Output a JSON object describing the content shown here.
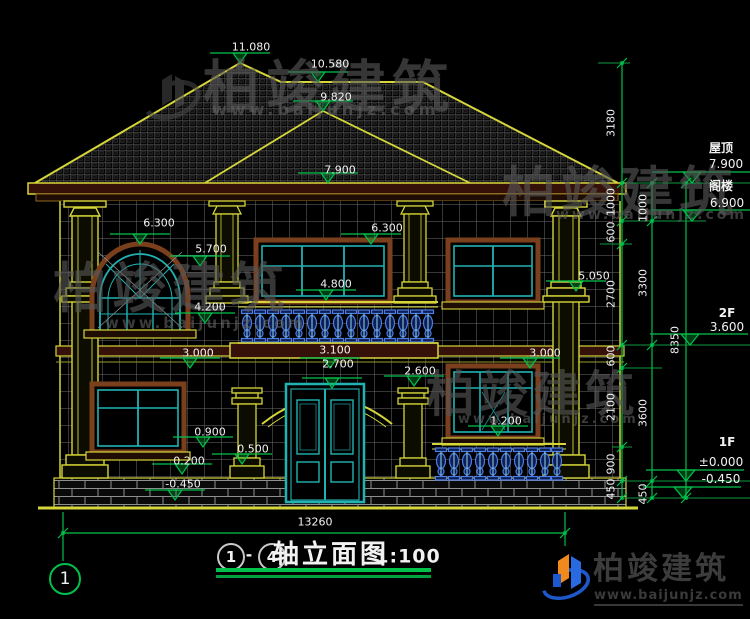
{
  "drawing_title": {
    "axis_from": "1",
    "axis_to": "4",
    "dash": "-",
    "name": "轴立面图",
    "scale": "1:100"
  },
  "left_axis_bubble": "1",
  "bottom_dimension": "13260",
  "elevations": [
    "11.080",
    "10.580",
    "9.820",
    "7.900",
    "6.300",
    "5.700",
    "6.300",
    "4.800",
    "5.050",
    "4.200",
    "3.000",
    "3.100",
    "2.700",
    "2.600",
    "3.000",
    "1.200",
    "0.900",
    "0.500",
    "0.200",
    "-0.450"
  ],
  "right_levels": {
    "roof_label": "屋顶",
    "roof_value": "7.900",
    "attic_label": "阁楼",
    "attic_value": "6.900",
    "f2_label": "2F",
    "f2_value": "3.600",
    "f1_label": "1F",
    "f1_zero": "±0.000",
    "f1_below": "-0.450"
  },
  "dim_columns": {
    "inner": [
      "3180",
      "1000",
      "600",
      "2700",
      "600",
      "2100",
      "900",
      "450"
    ],
    "middle": [
      "1000",
      "3300",
      "3600",
      "450"
    ],
    "outer": [
      "8350"
    ]
  },
  "brand": {
    "name": "柏竣建筑",
    "url": "www.baijunjz.com"
  },
  "colors": {
    "cad_yellow": "#d6d63a",
    "cad_green": "#00c24a",
    "cad_cyan": "#21b3b3",
    "frame_brown": "#7a3f1c",
    "baluster_blue": "#4d7de2",
    "text_white": "#f2f2f2"
  }
}
